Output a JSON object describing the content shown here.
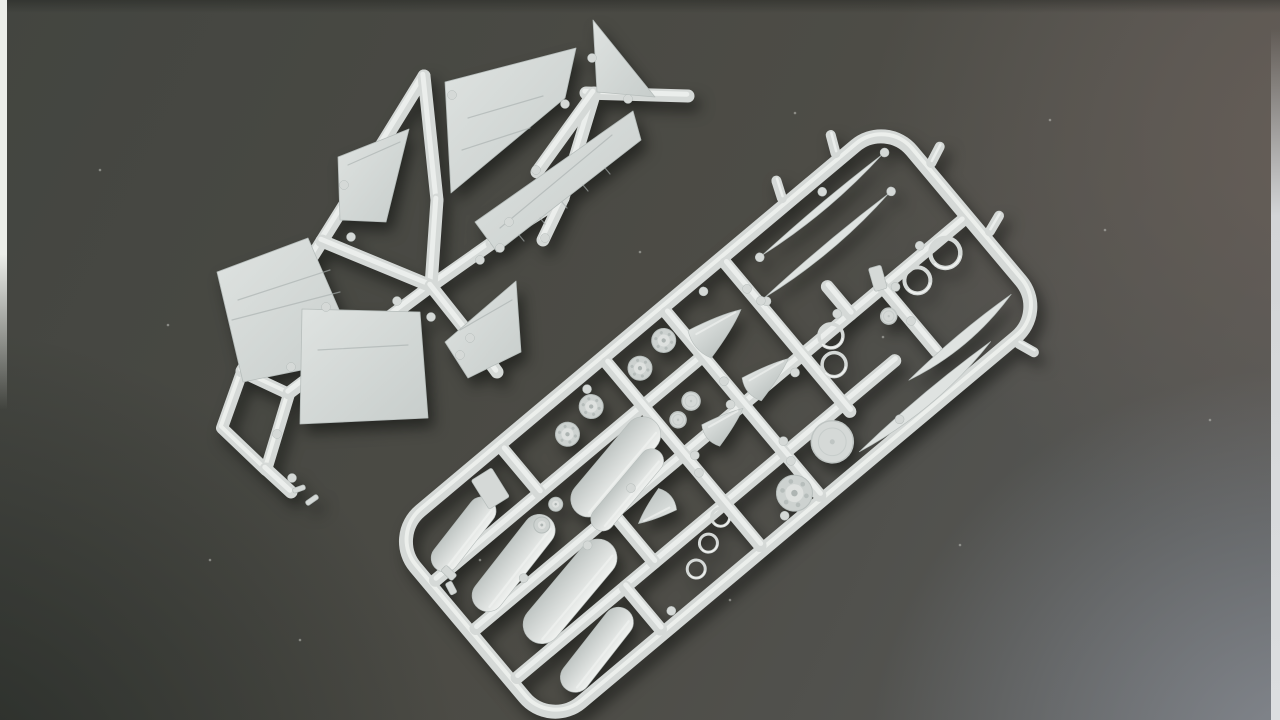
{
  "meta": {
    "description": "Photograph of two light grey injection-moulded plastic model aircraft kit sprues lying on a dark charcoal backdrop",
    "subject": "model kit sprues with wing panels, fins, drop tanks, wheels, rings, intake cones and small detail parts",
    "plastic_color_name": "light grey polystyrene"
  },
  "colors": {
    "bg1": "#434540",
    "bg2": "#4d4c46",
    "bg3": "#585a5a",
    "bg_dark": "#272b27",
    "bg_warm": "#675e57",
    "bg_light": "#84888f",
    "edge_left": "#eceee9",
    "edge_right": "#d3d5d7",
    "plastic": "#d5d9d7",
    "plastic_hi": "#f0f2f0",
    "plastic_lo": "#bfc5c3",
    "panel_a": "#dfe3e1",
    "panel_b": "#c7cdcb",
    "edge": "#b6bdbb",
    "scribe": "#aab1b0",
    "wheel_face": "#cdd2d0",
    "hub": "#dee1df",
    "hub_dot": "#aeb5b3",
    "speck": "#c9cbc6"
  },
  "wing_sprue": {
    "name": "wing-sprue",
    "loop": {
      "pts": [
        [
          242,
          372
        ],
        [
          289,
          394
        ],
        [
          266,
          470
        ],
        [
          222,
          428
        ]
      ],
      "w": 12
    },
    "segs": [
      [
        289,
        393,
        372,
        330
      ],
      [
        372,
        330,
        431,
        286
      ],
      [
        431,
        286,
        492,
        243
      ],
      [
        492,
        243,
        563,
        198
      ],
      [
        563,
        198,
        594,
        95
      ],
      [
        586,
        93,
        688,
        96
      ],
      [
        242,
        371,
        262,
        337
      ],
      [
        262,
        337,
        322,
        241
      ],
      [
        322,
        241,
        352,
        193
      ],
      [
        352,
        193,
        424,
        76
      ],
      [
        424,
        76,
        437,
        200
      ],
      [
        437,
        200,
        431,
        286
      ],
      [
        322,
        241,
        431,
        286
      ],
      [
        594,
        93,
        537,
        172
      ],
      [
        563,
        198,
        543,
        240
      ],
      [
        431,
        286,
        469,
        334
      ],
      [
        469,
        334,
        497,
        372
      ],
      [
        266,
        469,
        291,
        492
      ]
    ],
    "panels": [
      {
        "name": "tail-fin-panel",
        "pts": [
          [
            593,
            20
          ],
          [
            655,
            97
          ],
          [
            597,
            92
          ]
        ]
      },
      {
        "name": "wing-upper-panel",
        "pts": [
          [
            445,
            82
          ],
          [
            576,
            48
          ],
          [
            565,
            98
          ],
          [
            451,
            193
          ]
        ]
      },
      {
        "name": "stabilizer-long-panel",
        "pts": [
          [
            633,
            111
          ],
          [
            641,
            140
          ],
          [
            497,
            252
          ],
          [
            475,
            222
          ]
        ]
      },
      {
        "name": "stabilizer-small-panel",
        "pts": [
          [
            338,
            157
          ],
          [
            409,
            129
          ],
          [
            386,
            222
          ],
          [
            340,
            220
          ]
        ]
      },
      {
        "name": "wing-left-panel",
        "pts": [
          [
            217,
            272
          ],
          [
            308,
            238
          ],
          [
            360,
            358
          ],
          [
            243,
            382
          ]
        ]
      },
      {
        "name": "wing-lower-panel",
        "pts": [
          [
            302,
            309
          ],
          [
            420,
            312
          ],
          [
            428,
            418
          ],
          [
            300,
            424
          ]
        ]
      },
      {
        "name": "fin-half-panel",
        "pts": [
          [
            445,
            342
          ],
          [
            516,
            281
          ],
          [
            521,
            352
          ],
          [
            468,
            378
          ]
        ]
      }
    ],
    "ticks": [
      [
        605,
        168,
        610,
        174
      ],
      [
        583,
        185,
        588,
        191
      ],
      [
        562,
        202,
        567,
        208
      ],
      [
        540,
        218,
        545,
        224
      ],
      [
        519,
        235,
        524,
        241
      ],
      [
        468,
        118,
        543,
        96
      ],
      [
        462,
        150,
        530,
        128
      ],
      [
        238,
        300,
        330,
        270
      ],
      [
        318,
        350,
        408,
        345
      ],
      [
        612,
        135,
        500,
        228
      ],
      [
        348,
        165,
        400,
        142
      ],
      [
        232,
        320,
        340,
        292
      ],
      [
        460,
        330,
        512,
        300
      ]
    ],
    "plates": [
      [
        299,
        489,
        13,
        5,
        -20
      ],
      [
        312,
        500,
        14,
        5,
        -35
      ]
    ],
    "nubs": [
      [
        351,
        237
      ],
      [
        397,
        301
      ],
      [
        326,
        307
      ],
      [
        431,
        317
      ],
      [
        344,
        185
      ],
      [
        452,
        95
      ],
      [
        565,
        104
      ],
      [
        592,
        58
      ],
      [
        628,
        99
      ],
      [
        500,
        248
      ],
      [
        470,
        338
      ],
      [
        291,
        367
      ],
      [
        536,
        170
      ],
      [
        545,
        238
      ],
      [
        277,
        434
      ],
      [
        460,
        355
      ],
      [
        292,
        478
      ],
      [
        509,
        222
      ],
      [
        480,
        260
      ]
    ]
  },
  "parts_sprue": {
    "name": "parts-sprue",
    "tx": 886,
    "ty": 120,
    "rot": 50,
    "frame": {
      "w": 250,
      "l": 648,
      "corner": 40,
      "bar": 13
    },
    "stubs": [
      [
        -7,
        60,
        -24,
        52
      ],
      [
        -7,
        130,
        -24,
        123
      ],
      [
        62,
        -7,
        55,
        -24
      ],
      [
        152,
        -8,
        146,
        -25
      ],
      [
        257,
        42,
        273,
        36
      ]
    ],
    "segs": [
      [
        126,
        7,
        126,
        641
      ],
      [
        63,
        295,
        63,
        641
      ],
      [
        190,
        148,
        190,
        641
      ],
      [
        126,
        110,
        210,
        110
      ],
      [
        90,
        152,
        126,
        152
      ],
      [
        7,
        215,
        200,
        215
      ],
      [
        7,
        292,
        245,
        292
      ],
      [
        7,
        370,
        245,
        370
      ],
      [
        7,
        505,
        63,
        505
      ],
      [
        126,
        462,
        190,
        462
      ],
      [
        190,
        500,
        245,
        500
      ]
    ],
    "blades": [
      [
        24,
        25,
        182,
        7
      ],
      [
        58,
        45,
        207,
        8
      ],
      [
        214,
        16,
        150,
        11
      ],
      [
        237,
        62,
        234,
        12
      ]
    ],
    "rings": [
      [
        140,
        40,
        15,
        4.5
      ],
      [
        143,
        79,
        13,
        4
      ],
      [
        130,
        181,
        12,
        3.5
      ],
      [
        154,
        197,
        12,
        3.5
      ],
      [
        198,
        382,
        9,
        3
      ],
      [
        210,
        408,
        9,
        3
      ],
      [
        222,
        434,
        9,
        3
      ]
    ],
    "discs": [
      [
        152,
        124,
        8
      ],
      [
        90,
        330,
        9
      ],
      [
        96,
        352,
        8
      ],
      [
        212,
        248,
        21
      ]
    ],
    "wheels": [
      [
        26,
        312,
        12
      ],
      [
        32,
        348,
        12
      ],
      [
        30,
        410,
        12
      ],
      [
        36,
        446,
        12
      ],
      [
        227,
        310,
        18
      ],
      [
        82,
        500,
        7
      ],
      [
        89,
        524,
        8
      ]
    ],
    "cones": [
      [
        52,
        262,
        58,
        36,
        0
      ],
      [
        120,
        254,
        52,
        30,
        0
      ],
      [
        129,
        318,
        46,
        28,
        0
      ],
      [
        150,
        428,
        42,
        28,
        180
      ]
    ],
    "tanks": [
      [
        92,
        430,
        120,
        36,
        80
      ],
      [
        117,
        436,
        100,
        24,
        80
      ],
      [
        100,
        570,
        115,
        32,
        78
      ],
      [
        46,
        590,
        88,
        28,
        78
      ],
      [
        158,
        545,
        125,
        38,
        80
      ],
      [
        220,
        562,
        100,
        30,
        78
      ]
    ],
    "plates": [
      [
        28,
        540,
        34,
        24,
        8
      ],
      [
        116,
        108,
        24,
        13,
        24
      ],
      [
        66,
        626,
        15,
        8,
        -6
      ],
      [
        79,
        634,
        13,
        7,
        12
      ]
    ],
    "nubs": [
      [
        118,
        55
      ],
      [
        134,
        100
      ],
      [
        117,
        162
      ],
      [
        135,
        232
      ],
      [
        118,
        302
      ],
      [
        134,
        362
      ],
      [
        118,
        432
      ],
      [
        134,
        502
      ],
      [
        118,
        572
      ],
      [
        14,
        95
      ],
      [
        14,
        250
      ],
      [
        14,
        402
      ],
      [
        238,
        182
      ],
      [
        238,
        332
      ],
      [
        238,
        480
      ],
      [
        62,
        208
      ],
      [
        180,
        285
      ],
      [
        24,
        22
      ],
      [
        24,
        185
      ],
      [
        58,
        42
      ],
      [
        58,
        212
      ],
      [
        170,
        110
      ],
      [
        200,
        292
      ],
      [
        150,
        370
      ],
      [
        96,
        292
      ],
      [
        40,
        215
      ]
    ]
  },
  "specks": [
    [
      168,
      325
    ],
    [
      795,
      113
    ],
    [
      883,
      337
    ],
    [
      640,
      252
    ],
    [
      560,
      440
    ],
    [
      480,
      560
    ],
    [
      1105,
      230
    ],
    [
      300,
      640
    ],
    [
      960,
      545
    ],
    [
      100,
      170
    ],
    [
      730,
      600
    ],
    [
      1210,
      420
    ],
    [
      1050,
      120
    ],
    [
      210,
      560
    ]
  ]
}
